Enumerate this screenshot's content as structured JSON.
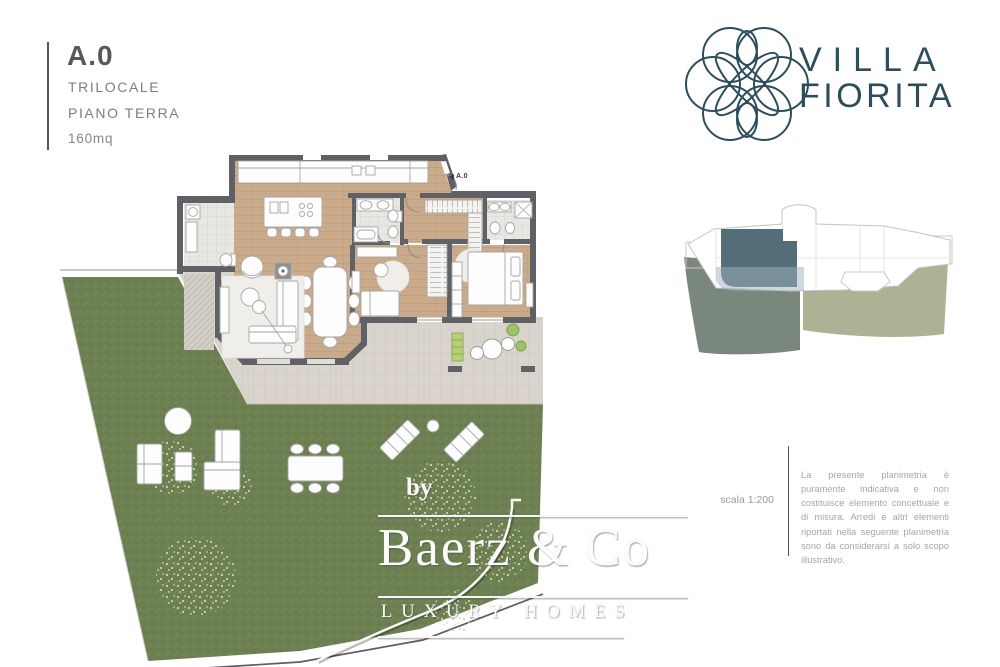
{
  "header": {
    "unit": "A.0",
    "type_label": "TRILOCALE",
    "floor_label": "PIANO TERRA",
    "area_label": "160mq"
  },
  "brand": {
    "name_line1": "VILLA",
    "name_line2": "FIORITA"
  },
  "floor_plan": {
    "entrance_label": "A.0"
  },
  "scale_note": {
    "label": "scala 1:200"
  },
  "disclaimer": {
    "text": "La presente planimetria è puramente indicativa e non costituisce elemento concettuale e di misura. Arredi e altri elementi riportati nella seguente planimetria sono da considerarsi a solo scopo illustrativo."
  },
  "watermark": {
    "prefix": "by",
    "name": "Baerz & Co",
    "tagline": "LUXURY HOMES"
  },
  "colors": {
    "brand_teal": "#2d4d5c",
    "garden_green": "#6d8052",
    "wood_floor": "#c9aa8b",
    "wall_gray": "#606167",
    "terrace_gray": "#d9d4cc",
    "site_unit_highlight": "#48626f",
    "site_garden_left": "#6e7d71",
    "site_garden_right": "#a9ae8e"
  }
}
